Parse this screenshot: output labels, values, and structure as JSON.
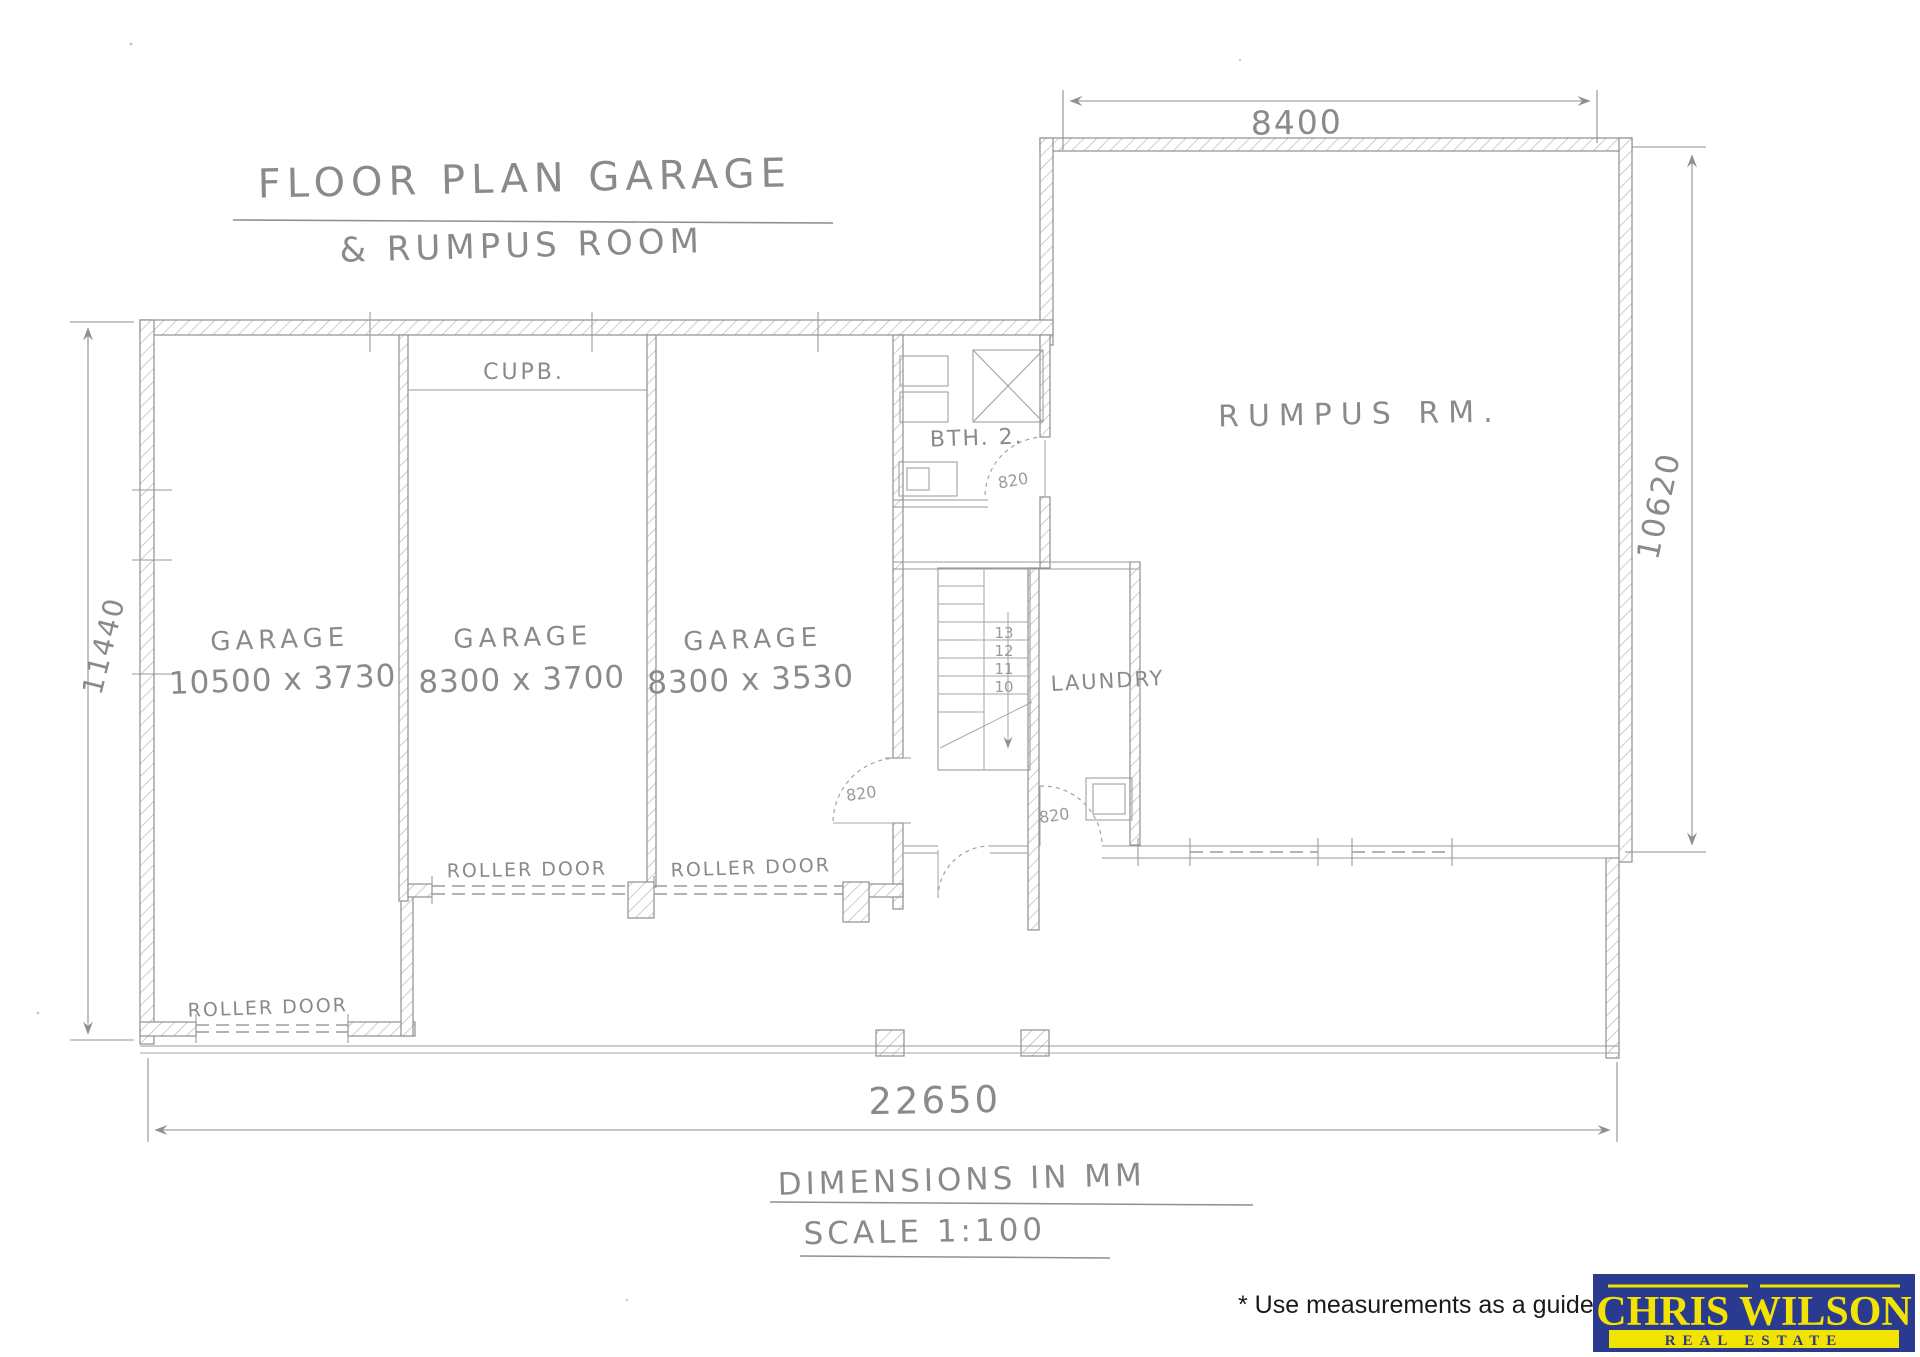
{
  "colors": {
    "pencil": "#8a8a8a",
    "logo_blue": "#2a3a8f",
    "logo_yellow": "#f2e300",
    "disclaimer_ink": "#1a1a1a"
  },
  "title": {
    "line1": "FLOOR PLAN GARAGE",
    "line2": "& RUMPUS ROOM"
  },
  "rooms": {
    "garage1": {
      "label": "GARAGE",
      "size": "10500 x 3730"
    },
    "garage2": {
      "label": "GARAGE",
      "size": "8300 x 3700"
    },
    "garage3": {
      "label": "GARAGE",
      "size": "8300 x 3530"
    },
    "rumpus": {
      "label": "RUMPUS  RM."
    },
    "laundry": {
      "label": "LAUNDRY"
    },
    "bathroom": {
      "label": "BTH. 2."
    },
    "cupboard": {
      "label": "CUPB."
    }
  },
  "doors": {
    "bathroom": "820",
    "garage": "820",
    "hall": "820"
  },
  "roller_doors": {
    "left": "ROLLER DOOR",
    "middle": "ROLLER DOOR",
    "right": "ROLLER DOOR"
  },
  "stairs": {
    "treads": [
      "13",
      "12",
      "11",
      "10"
    ]
  },
  "dimensions": {
    "top": "8400",
    "right": "10620",
    "left": "11440",
    "bottom": "22650"
  },
  "notes": {
    "units": "DIMENSIONS IN MM",
    "scale": "SCALE 1:100",
    "disclaimer": "* Use measurements as a guide only"
  },
  "logo": {
    "brand": "CHRIS WILSON",
    "tagline": "REAL ESTATE"
  }
}
